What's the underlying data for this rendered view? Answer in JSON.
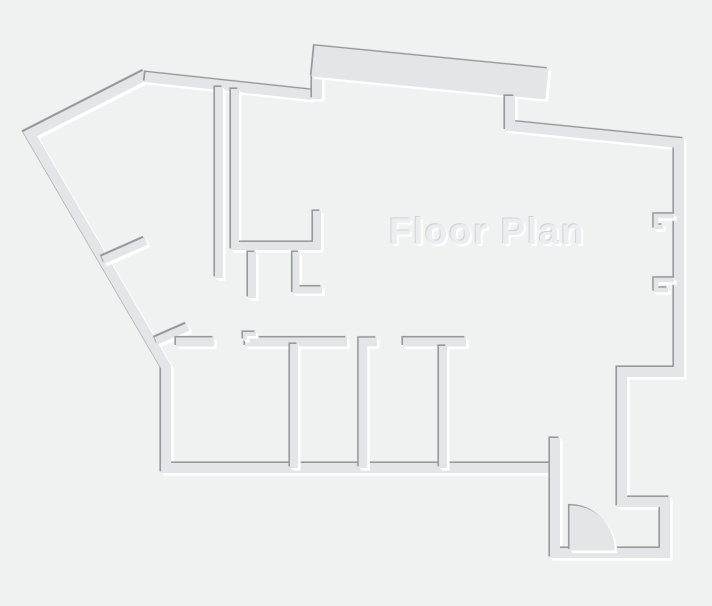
{
  "title": "Floor Plan",
  "canvas": {
    "width": 712,
    "height": 606
  },
  "palette": {
    "background": "#f0f1f1",
    "wall_fill": "#e3e5e6",
    "shadow_dark": "#97999b",
    "highlight": "#ffffff",
    "title_fill": "#ecedee",
    "title_shadow_dark": "#cfd2d3",
    "title_shadow_light": "#ffffff"
  }
}
